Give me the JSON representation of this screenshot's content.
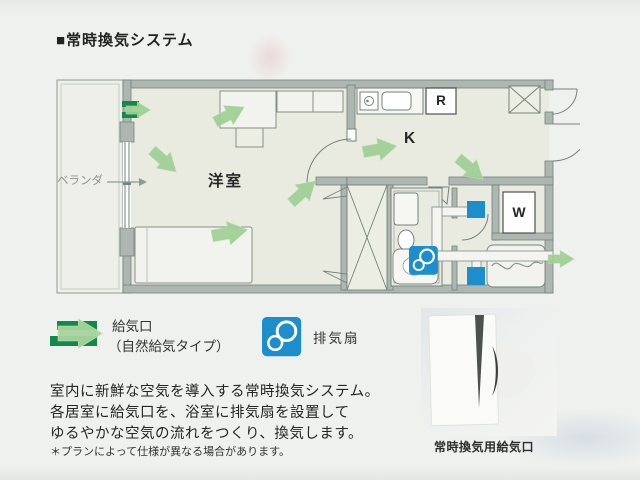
{
  "page": {
    "title": "■常時換気システム"
  },
  "floor_plan": {
    "labels": {
      "balcony": "ベランダ",
      "western_room": "洋室",
      "kitchen": "K",
      "refrigerator": "R",
      "washing_machine": "W"
    }
  },
  "legend": {
    "supply": {
      "label_line1": "給気口",
      "label_line2": "（自然給気タイプ）"
    },
    "exhaust": {
      "label": "排気扇"
    }
  },
  "description": {
    "lines": [
      "室内に新鮮な空気を導入する常時換気システム。",
      "各居室に給気口を、浴室に排気扇を設置して",
      "ゆるやかな空気の流れをつくり、換気します。"
    ],
    "note": "＊プランによって仕様が異なる場合があります。"
  },
  "photo": {
    "caption": "常時換気用給気口"
  },
  "colors": {
    "supply_green_dark": "#12894a",
    "airflow_green": "#9fcf93",
    "exhaust_blue": "#1b8ecb",
    "wall_gray": "#adb6b0",
    "floor": "#e9ebe1",
    "page_background": "#eff1ee"
  }
}
